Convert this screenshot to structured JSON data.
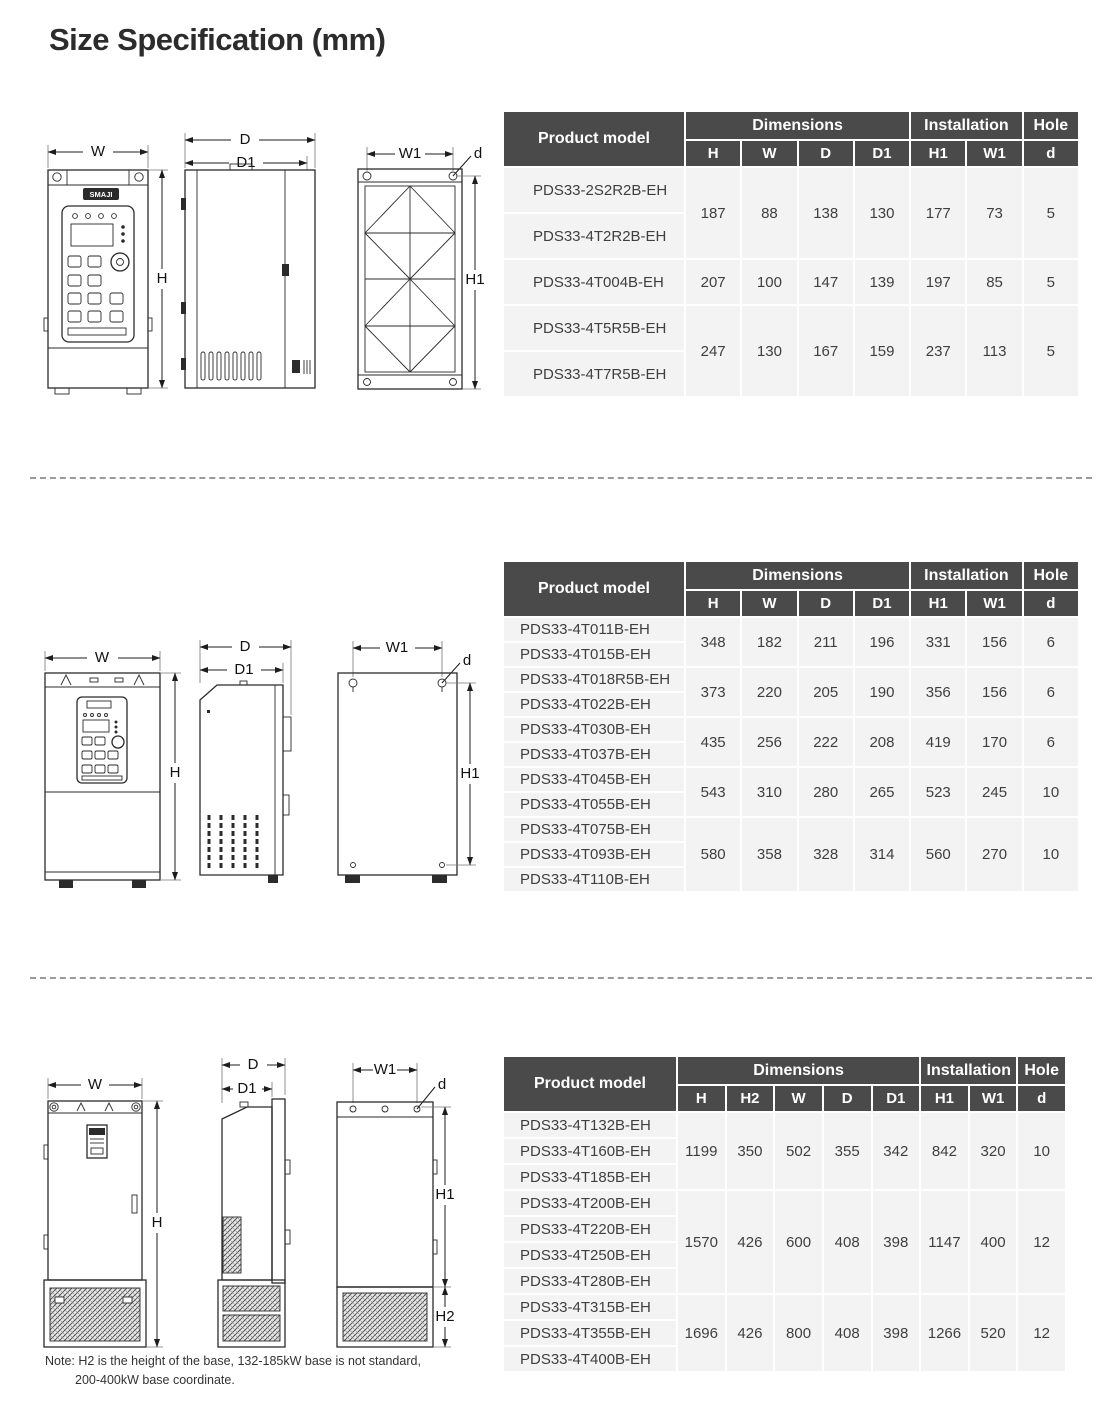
{
  "title": "Size Specification (mm)",
  "note": {
    "line1": "Note: H2 is the height of the base, 132-185kW base is not standard,",
    "line2": "200-400kW base coordinate."
  },
  "diagram_labels": {
    "W": "W",
    "H": "H",
    "D": "D",
    "D1": "D1",
    "W1": "W1",
    "H1": "H1",
    "H2": "H2",
    "d": "d",
    "logo": "SMAJI"
  },
  "colors": {
    "header_bg": "#4a4a4a",
    "header_text": "#ffffff",
    "row_bg": "#f3f3f3",
    "cell_text": "#3f3f3f"
  },
  "tables": [
    {
      "name": "small-frames",
      "header": {
        "product_model": "Product model",
        "dimensions": "Dimensions",
        "installation": "Installation",
        "hole": "Hole",
        "sub": [
          "H",
          "W",
          "D",
          "D1",
          "H1",
          "W1",
          "d"
        ]
      },
      "groups": [
        {
          "models": [
            "PDS33-2S2R2B-EH",
            "PDS33-4T2R2B-EH"
          ],
          "values": [
            "187",
            "88",
            "138",
            "130",
            "177",
            "73",
            "5"
          ]
        },
        {
          "models": [
            "PDS33-4T004B-EH"
          ],
          "values": [
            "207",
            "100",
            "147",
            "139",
            "197",
            "85",
            "5"
          ]
        },
        {
          "models": [
            "PDS33-4T5R5B-EH",
            "PDS33-4T7R5B-EH"
          ],
          "values": [
            "247",
            "130",
            "167",
            "159",
            "237",
            "113",
            "5"
          ]
        }
      ]
    },
    {
      "name": "medium-frames",
      "header": {
        "product_model": "Product model",
        "dimensions": "Dimensions",
        "installation": "Installation",
        "hole": "Hole",
        "sub": [
          "H",
          "W",
          "D",
          "D1",
          "H1",
          "W1",
          "d"
        ]
      },
      "groups": [
        {
          "models": [
            "PDS33-4T011B-EH",
            "PDS33-4T015B-EH"
          ],
          "values": [
            "348",
            "182",
            "211",
            "196",
            "331",
            "156",
            "6"
          ]
        },
        {
          "models": [
            "PDS33-4T018R5B-EH",
            "PDS33-4T022B-EH"
          ],
          "values": [
            "373",
            "220",
            "205",
            "190",
            "356",
            "156",
            "6"
          ]
        },
        {
          "models": [
            "PDS33-4T030B-EH",
            "PDS33-4T037B-EH"
          ],
          "values": [
            "435",
            "256",
            "222",
            "208",
            "419",
            "170",
            "6"
          ]
        },
        {
          "models": [
            "PDS33-4T045B-EH",
            "PDS33-4T055B-EH"
          ],
          "values": [
            "543",
            "310",
            "280",
            "265",
            "523",
            "245",
            "10"
          ]
        },
        {
          "models": [
            "PDS33-4T075B-EH",
            "PDS33-4T093B-EH",
            "PDS33-4T110B-EH"
          ],
          "values": [
            "580",
            "358",
            "328",
            "314",
            "560",
            "270",
            "10"
          ]
        }
      ]
    },
    {
      "name": "large-frames",
      "header": {
        "product_model": "Product model",
        "dimensions": "Dimensions",
        "installation": "Installation",
        "hole": "Hole",
        "sub": [
          "H",
          "H2",
          "W",
          "D",
          "D1",
          "H1",
          "W1",
          "d"
        ]
      },
      "groups": [
        {
          "models": [
            "PDS33-4T132B-EH",
            "PDS33-4T160B-EH",
            "PDS33-4T185B-EH"
          ],
          "values": [
            "1199",
            "350",
            "502",
            "355",
            "342",
            "842",
            "320",
            "10"
          ]
        },
        {
          "models": [
            "PDS33-4T200B-EH",
            "PDS33-4T220B-EH",
            "PDS33-4T250B-EH",
            "PDS33-4T280B-EH"
          ],
          "values": [
            "1570",
            "426",
            "600",
            "408",
            "398",
            "1147",
            "400",
            "12"
          ]
        },
        {
          "models": [
            "PDS33-4T315B-EH",
            "PDS33-4T355B-EH",
            "PDS33-4T400B-EH"
          ],
          "values": [
            "1696",
            "426",
            "800",
            "408",
            "398",
            "1266",
            "520",
            "12"
          ]
        }
      ]
    }
  ]
}
